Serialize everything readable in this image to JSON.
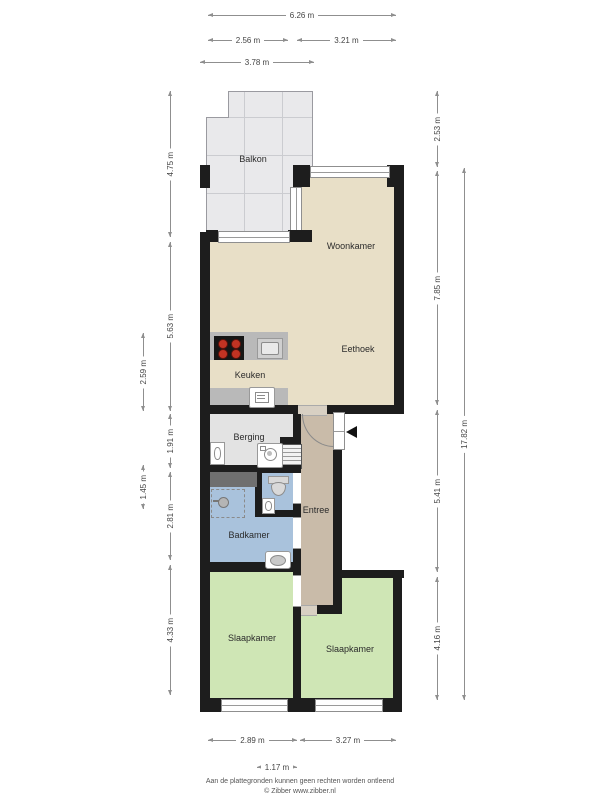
{
  "rooms": {
    "balkon": "Balkon",
    "woonkamer": "Woonkamer",
    "eethoek": "Eethoek",
    "keuken": "Keuken",
    "berging": "Berging",
    "entree": "Entree",
    "badkamer": "Badkamer",
    "slaapkamer_links": "Slaapkamer",
    "slaapkamer_rechts": "Slaapkamer"
  },
  "dimensions": {
    "top_total": "6.26 m",
    "top_left": "2.56 m",
    "top_right": "3.21 m",
    "top_balkon": "3.78 m",
    "left_outer": {
      "keuken": "2.59 m",
      "wc": "1.45 m"
    },
    "left_inner": {
      "balkon": "4.75 m",
      "woonkamer": "5.63 m",
      "berging": "1.91 m",
      "badkamer": "2.81 m",
      "slaapkamer": "4.33 m"
    },
    "right_inner": {
      "balkon": "2.53 m",
      "woonkamer": "7.85 m",
      "entree": "5.41 m",
      "slaapkamer": "4.16 m"
    },
    "right_outer": {
      "totaal": "17.82 m"
    },
    "bottom_left": "2.89 m",
    "bottom_right": "3.27 m",
    "bottom_small": "1.17 m"
  },
  "footer": {
    "disclaimer": "Aan de plattegronden kunnen geen rechten worden ontleend",
    "copyright": "© Zibber www.zibber.nl"
  },
  "colors": {
    "wall": "#1d1d1d",
    "living_floor": "#e8dfc7",
    "hall_floor": "#c9bba9",
    "bathroom_floor": "#a9c2dc",
    "bedroom_floor": "#cfe6b5",
    "storage_floor": "#e3e3e3",
    "balcony_floor": "#e9e9eb",
    "counter": "#b9b9b9",
    "burner": "#c23323",
    "cabinet_dark": "#6f6f6f"
  }
}
